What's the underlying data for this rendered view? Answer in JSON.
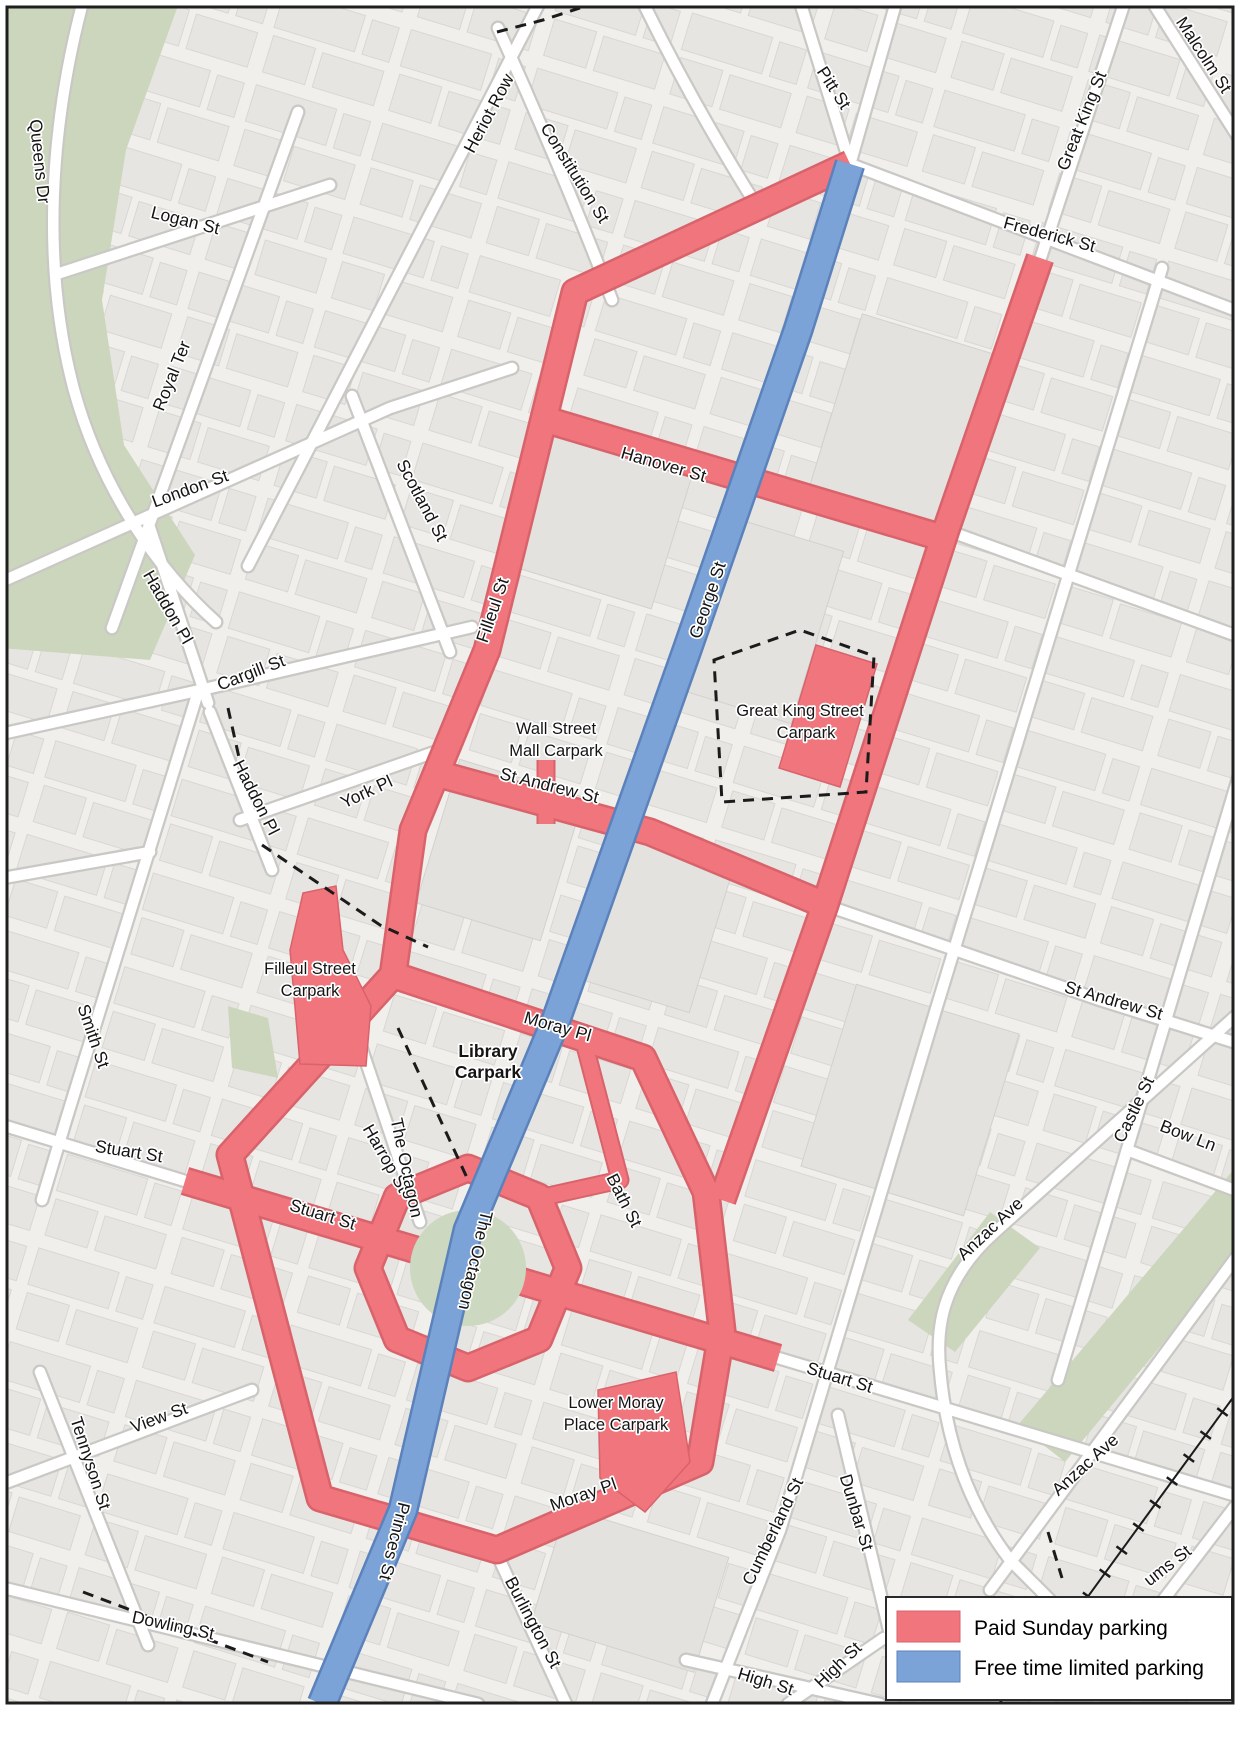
{
  "legend": {
    "items": [
      {
        "label": "Paid Sunday parking",
        "color": "#f0757c"
      },
      {
        "label": "Free time limited parking",
        "color": "#7ba3d8"
      }
    ]
  },
  "colors": {
    "paid_parking": "#f0757c",
    "paid_parking_edge": "#d9636b",
    "free_parking": "#7ba3d8",
    "free_parking_edge": "#5c82bb",
    "road": "#ffffff",
    "background": "#f1efec",
    "park_green": "#ccd6bd",
    "label_text": "#141414"
  },
  "streets": {
    "queens_dr": "Queens Dr",
    "logan_st": "Logan St",
    "heriot_row": "Heriot Row",
    "constitution_st": "Constitution St",
    "pitt_st": "Pitt St",
    "great_king_st": "Great King St",
    "malcolm_st": "Malcolm St",
    "frederick_st": "Frederick St",
    "royal_ter": "Royal Ter",
    "london_st": "London St",
    "scotland_st": "Scotland St",
    "haddon_pl": "Haddon Pl",
    "cargill_st": "Cargill St",
    "york_pl": "York Pl",
    "filleul_st": "Filleul St",
    "hanover_st": "Hanover St",
    "george_st": "George St",
    "st_andrew_st": "St Andrew St",
    "smith_st": "Smith St",
    "moray_pl": "Moray Pl",
    "castle_st": "Castle St",
    "bow_ln": "Bow Ln",
    "stuart_st": "Stuart St",
    "harrop_st": "Harrop St",
    "bath_st": "Bath St",
    "the_octagon": "The Octagon",
    "anzac_ave": "Anzac Ave",
    "princes_st": "Princes St",
    "cumberland_st": "Cumberland St",
    "dunbar_st": "Dunbar St",
    "dowling_st": "Dowling St",
    "tennyson_st": "Tennyson St",
    "view_st": "View St",
    "burlington_st": "Burlington St",
    "high_st": "High St",
    "ums_st": "ums St"
  },
  "carparks": {
    "wall": {
      "line1": "Wall Street",
      "line2": "Mall Carpark"
    },
    "great_king": {
      "line1": "Great King Street",
      "line2": "Carpark"
    },
    "filleul": {
      "line1": "Filleul Street",
      "line2": "Carpark"
    },
    "library": {
      "line1": "Library",
      "line2": "Carpark"
    },
    "lower_moray": {
      "line1": "Lower Moray",
      "line2": "Place Carpark"
    }
  }
}
